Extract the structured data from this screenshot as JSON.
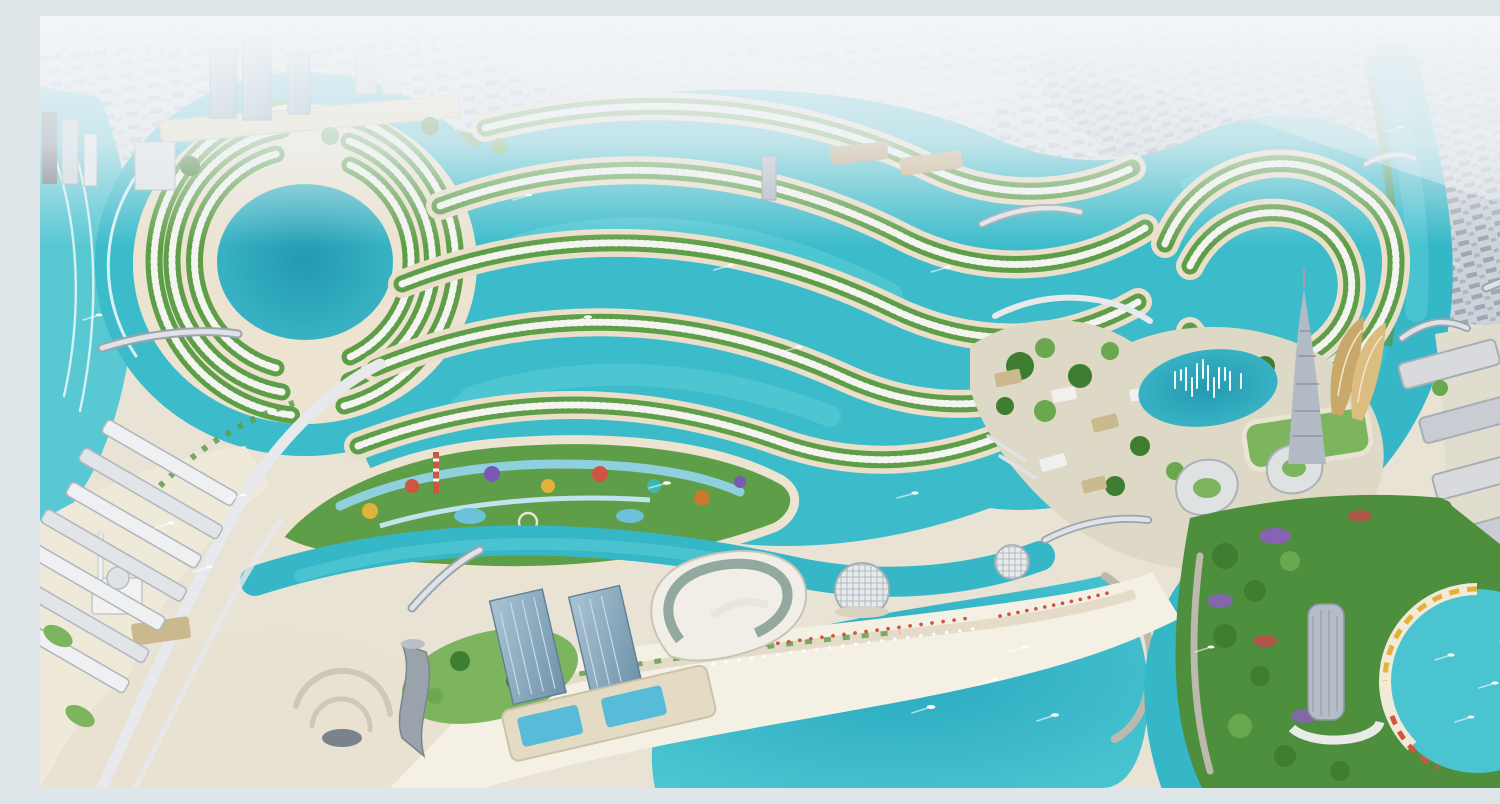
{
  "scene": {
    "title": "Aerial render of a coastal lagoon master-planned city",
    "description": "Daytime bird's-eye rendering: serpentine turquoise canals lined with curved rows of white villas, a circular lagoon island of crescent villa arcs, a colourful water-park island, a white-sand swimming bay, a landmark spire tower with fountain lake, and hazy low-rise city sprawl fading to the horizon.",
    "regions": [
      {
        "id": "haze-city",
        "label": "Hazy low-rise city sprawl on the horizon"
      },
      {
        "id": "dense-district",
        "label": "Dense grey urban grid district (north-east)"
      },
      {
        "id": "left-ocean",
        "label": "Open sea with surf along the west shore"
      },
      {
        "id": "circular-lagoon",
        "label": "Circular lagoon island with crescent villa rows"
      },
      {
        "id": "serpentine-canals",
        "label": "Serpentine canals with curved villa berms"
      },
      {
        "id": "loop-island",
        "label": "Looped canal villa islands (north-east)"
      },
      {
        "id": "resort-village",
        "label": "Low-rise resort village with marina piers"
      },
      {
        "id": "fountain-lake",
        "label": "Lake with white fountain jets"
      },
      {
        "id": "spire-tower",
        "label": "Landmark spire skyscraper"
      },
      {
        "id": "sail-buildings",
        "label": "Curved sail-shaped buildings"
      },
      {
        "id": "petal-buildings",
        "label": "Three petal-shaped buildings with green courts"
      },
      {
        "id": "green-podium",
        "label": "Green-roofed podium mall"
      },
      {
        "id": "east-river",
        "label": "River channel with bridges (east)"
      },
      {
        "id": "east-apartments",
        "label": "Waterfront apartment blocks (east bank)"
      },
      {
        "id": "water-park",
        "label": "Water-park island with colourful slides"
      },
      {
        "id": "beachfront",
        "label": "White-sand beachfront with umbrellas"
      },
      {
        "id": "swimming-bay",
        "label": "Turquoise swimming bay with breakwater"
      },
      {
        "id": "beach-towers",
        "label": "Twin glass towers on pool podium"
      },
      {
        "id": "opera-building",
        "label": "Curved glass cultural building"
      },
      {
        "id": "dome-pavilions",
        "label": "Latticed dome pavilions"
      },
      {
        "id": "headland-park",
        "label": "Flowered headland park, hotel tower and cove"
      },
      {
        "id": "mosque",
        "label": "White mosque with dome and minaret"
      },
      {
        "id": "amphitheatre",
        "label": "Fan-shaped amphitheatre"
      },
      {
        "id": "twisted-tower",
        "label": "Twisted high-rise tower (south-west)"
      },
      {
        "id": "left-terraces",
        "label": "Terraced beachfront apartments (west edge)"
      },
      {
        "id": "northwest-towers",
        "label": "High-rise cluster and cream mall (north-west)"
      },
      {
        "id": "bridges",
        "label": "Road bridges over the canals"
      },
      {
        "id": "boats",
        "label": "Leisure boats with white wakes"
      }
    ],
    "counts": {
      "boats_visible_approx": 30,
      "fountain_jets_approx": 12,
      "villa_berm_rows": 7
    },
    "palette": {
      "canal_turquoise": "#35b7c8",
      "lagoon_deep": "#27a0b6",
      "shallow_water": "#a9e3e6",
      "sand": "#eadfc9",
      "bright_beach": "#f6f1e6",
      "greenery_dark": "#3f7d31",
      "greenery_light": "#6aa84f",
      "villa_white": "#f4f5f1",
      "city_block_grey": "#b5bcc5",
      "haze_white": "#f1f4f6",
      "glass_blue": "#8fb0c4",
      "cream_building": "#e7dcb6",
      "flower_purple": "#8d5fc0",
      "flower_red": "#c24b4b",
      "promenade_yellow": "#e0b23c"
    }
  }
}
